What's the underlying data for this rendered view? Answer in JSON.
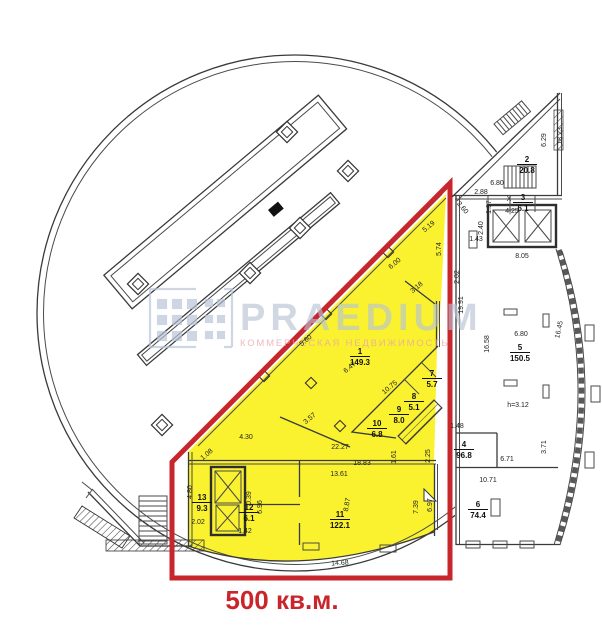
{
  "highlight": {
    "label": "500 кв.м.",
    "fill_color": "#faf22f",
    "outline_color": "#c9252c"
  },
  "watermark": {
    "brand": "PRAEDIUM",
    "subtitle": "КОММЕРЧЕСКАЯ НЕДВИЖИМОСТЬ",
    "brand_color": "#b7c3d6",
    "subtitle_color": "#e9a3ab"
  },
  "plan": {
    "rooms": [
      {
        "n": "1",
        "a": "149.3",
        "x": 360,
        "y": 356
      },
      {
        "n": "2",
        "a": "20.8",
        "x": 527,
        "y": 164
      },
      {
        "n": "3",
        "a": "6.1",
        "x": 523,
        "y": 202
      },
      {
        "n": "4",
        "a": "96.8",
        "x": 464,
        "y": 449
      },
      {
        "n": "5",
        "a": "150.5",
        "x": 520,
        "y": 352
      },
      {
        "n": "6",
        "a": "74.4",
        "x": 478,
        "y": 509
      },
      {
        "n": "7",
        "a": "5.7",
        "x": 432,
        "y": 378
      },
      {
        "n": "8",
        "a": "5.1",
        "x": 414,
        "y": 401
      },
      {
        "n": "9",
        "a": "8.0",
        "x": 399,
        "y": 414
      },
      {
        "n": "10",
        "a": "6.8",
        "x": 377,
        "y": 428
      },
      {
        "n": "11",
        "a": "122.1",
        "x": 340,
        "y": 519
      },
      {
        "n": "12",
        "a": "6.1",
        "x": 249,
        "y": 512
      },
      {
        "n": "13",
        "a": "9.3",
        "x": 202,
        "y": 502
      }
    ],
    "dimensions": [
      {
        "t": "18.23",
        "x": 562,
        "y": 136,
        "r": -90
      },
      {
        "t": "6.29",
        "x": 546,
        "y": 140,
        "r": -90
      },
      {
        "t": "6.80",
        "x": 497,
        "y": 185,
        "r": 0
      },
      {
        "t": "2.88",
        "x": 481,
        "y": 194,
        "r": 0
      },
      {
        "t": "1.97",
        "x": 491,
        "y": 207,
        "r": -90
      },
      {
        "t": "2.60",
        "x": 461,
        "y": 209,
        "r": 50
      },
      {
        "t": "X",
        "x": 509,
        "y": 201,
        "r": 0
      },
      {
        "t": "4|25",
        "x": 512,
        "y": 213,
        "r": 0
      },
      {
        "t": "2.40",
        "x": 483,
        "y": 228,
        "r": -90
      },
      {
        "t": "1.43",
        "x": 476,
        "y": 241,
        "r": 0
      },
      {
        "t": "8.05",
        "x": 522,
        "y": 258,
        "r": 0
      },
      {
        "t": "2.02",
        "x": 459,
        "y": 277,
        "r": -90
      },
      {
        "t": "19.91",
        "x": 463,
        "y": 305,
        "r": -90
      },
      {
        "t": "16.58",
        "x": 489,
        "y": 344,
        "r": -90
      },
      {
        "t": "6.80",
        "x": 521,
        "y": 336,
        "r": 0
      },
      {
        "t": "16.45",
        "x": 561,
        "y": 330,
        "r": -78
      },
      {
        "t": "h=3.12",
        "x": 518,
        "y": 407,
        "r": 0
      },
      {
        "t": "1.48",
        "x": 457,
        "y": 428,
        "r": 0
      },
      {
        "t": "3.71",
        "x": 546,
        "y": 447,
        "r": -90
      },
      {
        "t": "6.71",
        "x": 507,
        "y": 461,
        "r": 0
      },
      {
        "t": "10.71",
        "x": 488,
        "y": 482,
        "r": 0
      },
      {
        "t": "5.19",
        "x": 430,
        "y": 228,
        "r": -40
      },
      {
        "t": "5.74",
        "x": 441,
        "y": 249,
        "r": -90
      },
      {
        "t": "6.00",
        "x": 396,
        "y": 265,
        "r": -40
      },
      {
        "t": "3.18",
        "x": 418,
        "y": 289,
        "r": -40
      },
      {
        "t": "5.60",
        "x": 307,
        "y": 342,
        "r": -40
      },
      {
        "t": "6.47",
        "x": 351,
        "y": 369,
        "r": -40
      },
      {
        "t": "10.75",
        "x": 391,
        "y": 389,
        "r": -40
      },
      {
        "t": "3.57",
        "x": 311,
        "y": 420,
        "r": -40
      },
      {
        "t": "4.30",
        "x": 246,
        "y": 439,
        "r": 0
      },
      {
        "t": "22.27",
        "x": 340,
        "y": 449,
        "r": 0
      },
      {
        "t": "2.25",
        "x": 430,
        "y": 456,
        "r": -90
      },
      {
        "t": "1.61",
        "x": 396,
        "y": 457,
        "r": -90
      },
      {
        "t": "18.83",
        "x": 362,
        "y": 465,
        "r": 0
      },
      {
        "t": "13.61",
        "x": 339,
        "y": 476,
        "r": 0
      },
      {
        "t": "8.87",
        "x": 349,
        "y": 505,
        "r": -80
      },
      {
        "t": "7.39",
        "x": 418,
        "y": 507,
        "r": -90
      },
      {
        "t": "6.97",
        "x": 432,
        "y": 505,
        "r": -90
      },
      {
        "t": "14.68",
        "x": 340,
        "y": 565,
        "r": -3
      },
      {
        "t": "1.08",
        "x": 208,
        "y": 456,
        "r": -40
      },
      {
        "t": "4.80",
        "x": 192,
        "y": 492,
        "r": -90
      },
      {
        "t": "0.39",
        "x": 251,
        "y": 498,
        "r": -90
      },
      {
        "t": "6.96",
        "x": 262,
        "y": 507,
        "r": -90
      },
      {
        "t": "2.02",
        "x": 198,
        "y": 524,
        "r": 0
      },
      {
        "t": "1.42",
        "x": 245,
        "y": 533,
        "r": 0
      }
    ],
    "columns_large": [
      {
        "x": 287,
        "y": 132
      },
      {
        "x": 348,
        "y": 171
      },
      {
        "x": 300,
        "y": 228
      },
      {
        "x": 250,
        "y": 273
      },
      {
        "x": 138,
        "y": 284
      },
      {
        "x": 162,
        "y": 425
      }
    ],
    "columns_small": [
      {
        "x": 311,
        "y": 383
      },
      {
        "x": 340,
        "y": 426
      },
      {
        "x": 388,
        "y": 252
      },
      {
        "x": 326,
        "y": 314
      },
      {
        "x": 264,
        "y": 376
      }
    ]
  }
}
